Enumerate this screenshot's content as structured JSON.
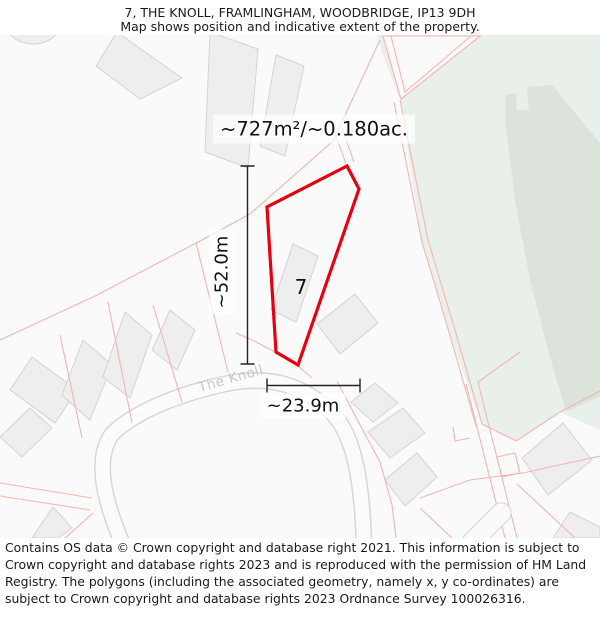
{
  "header": {
    "title": "7, THE KNOLL, FRAMLINGHAM, WOODBRIDGE, IP13 9DH",
    "subtitle": "Map shows position and indicative extent of the property."
  },
  "map": {
    "area_label": "~727m²/~0.180ac.",
    "plot_number": "7",
    "height_label": "~52.0m",
    "width_label": "~23.9m",
    "street_label": "The Knoll"
  },
  "footer": {
    "text": "Contains OS data © Crown copyright and database right 2021. This information is subject to Crown copyright and database rights 2023 and is reproduced with the permission of HM Land Registry. The polygons (including the associated geometry, namely x, y co-ordinates) are subject to Crown copyright and database rights 2023 Ordnance Survey 100026316."
  },
  "colors": {
    "property_outline": "#e8000d",
    "parcel_line": "#f4b6af",
    "greenspace": "#e9efe9",
    "greenspace_dark": "#dbe3da",
    "building_fill": "#efeeee",
    "building_stroke": "#d5d2d2",
    "road_casing": "#d8d6d6",
    "measure_line": "#222222",
    "street_text": "#c6c6c6",
    "text": "#1a1a1a"
  }
}
